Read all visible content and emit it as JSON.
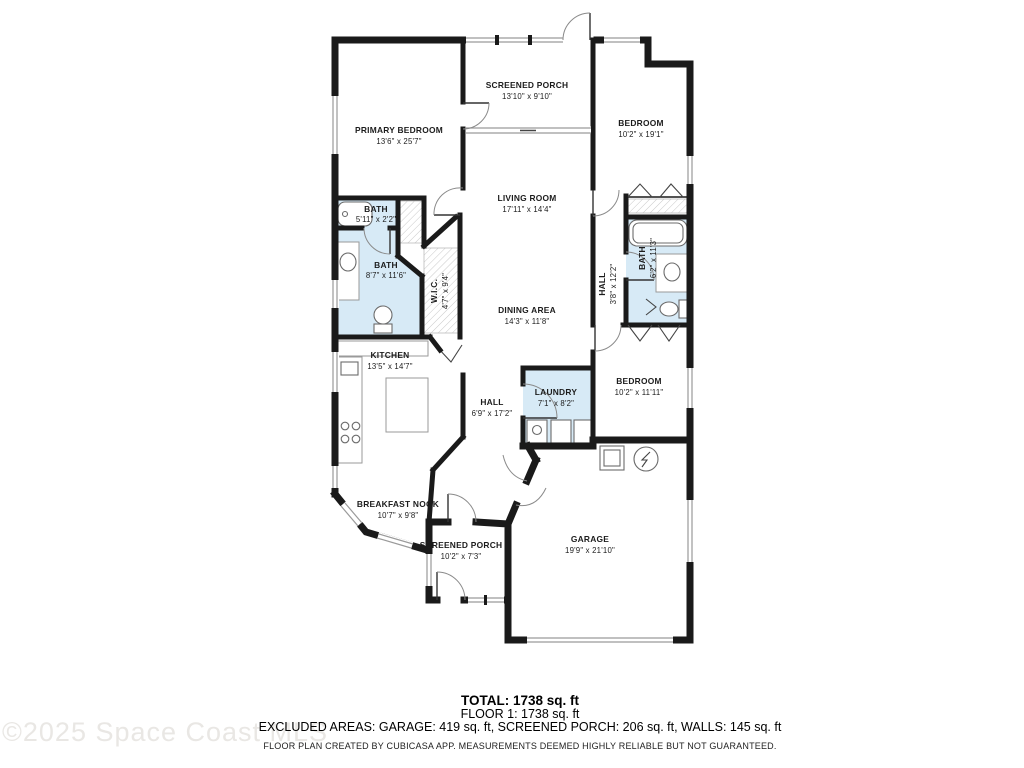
{
  "watermark": "©2025 Space Coast MLS",
  "footer": {
    "total": "TOTAL: 1738 sq. ft",
    "floor": "FLOOR 1: 1738 sq. ft",
    "excluded": "EXCLUDED AREAS: GARAGE: 419 sq. ft, SCREENED PORCH: 206 sq. ft, WALLS: 145 sq. ft",
    "disclaimer": "FLOOR PLAN CREATED BY CUBICASA APP. MEASUREMENTS DEEMED HIGHLY RELIABLE BUT NOT GUARANTEED."
  },
  "rooms": [
    {
      "id": "screened-porch-top",
      "name": "SCREENED PORCH",
      "dims": "13'10\" x 9'10\""
    },
    {
      "id": "primary-bedroom",
      "name": "PRIMARY BEDROOM",
      "dims": "13'6\" x 25'7\""
    },
    {
      "id": "bedroom-top-right",
      "name": "BEDROOM",
      "dims": "10'2\" x 19'1\""
    },
    {
      "id": "living-room",
      "name": "LIVING ROOM",
      "dims": "17'11\" x 14'4\""
    },
    {
      "id": "bath-small",
      "name": "BATH",
      "dims": "5'11\" x 2'2\""
    },
    {
      "id": "bath-primary",
      "name": "BATH",
      "dims": "8'7\" x 11'6\""
    },
    {
      "id": "wic",
      "name": "W.I.C.",
      "dims": "4'7\" x 9'4\""
    },
    {
      "id": "hall-right",
      "name": "HALL",
      "dims": "3'8\" x 12'2\""
    },
    {
      "id": "bath-right",
      "name": "BATH",
      "dims": "6'2\" x 11'3\""
    },
    {
      "id": "dining-area",
      "name": "DINING AREA",
      "dims": "14'3\" x 11'8\""
    },
    {
      "id": "kitchen",
      "name": "KITCHEN",
      "dims": "13'5\" x 14'7\""
    },
    {
      "id": "hall-center",
      "name": "HALL",
      "dims": "6'9\" x 17'2\""
    },
    {
      "id": "laundry",
      "name": "LAUNDRY",
      "dims": "7'1\" x 8'2\""
    },
    {
      "id": "bedroom-right",
      "name": "BEDROOM",
      "dims": "10'2\" x 11'11\""
    },
    {
      "id": "breakfast-nook",
      "name": "BREAKFAST NOOK",
      "dims": "10'7\" x 9'8\""
    },
    {
      "id": "screened-porch-bottom",
      "name": "SCREENED PORCH",
      "dims": "10'2\" x 7'3\""
    },
    {
      "id": "garage",
      "name": "GARAGE",
      "dims": "19'9\" x 21'10\""
    }
  ],
  "colors": {
    "wall": "#1a1a1a",
    "wet_room": "#d7eaf6",
    "window": "#9a9a9a",
    "hatch": "#c6c6c6",
    "watermark_text": "#e9e7e4",
    "label_text": "#1c1c1c"
  }
}
